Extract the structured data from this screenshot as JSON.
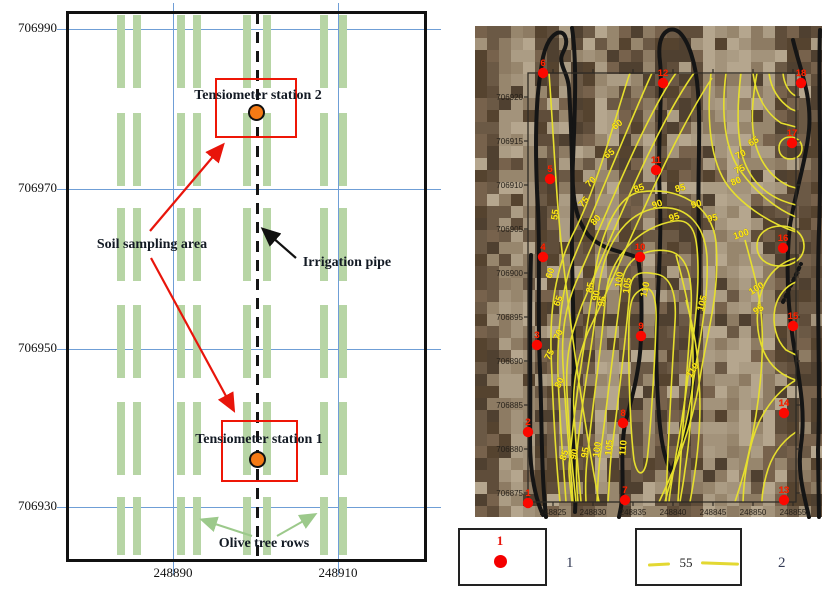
{
  "left_panel": {
    "annotations": {
      "station2": "Tensiometer station 2",
      "station1": "Tensiometer station 1",
      "soil_sampling_area": "Soil sampling area",
      "irrigation_pipe": "Irrigation pipe",
      "olive_tree_rows": "Olive tree rows"
    },
    "y_axis": [
      {
        "label": "706990",
        "y": 29
      },
      {
        "label": "706970",
        "y": 189
      },
      {
        "label": "706950",
        "y": 349
      },
      {
        "label": "706930",
        "y": 507
      }
    ],
    "x_axis": [
      {
        "label": "248890",
        "x": 173
      },
      {
        "label": "248910",
        "x": 338
      }
    ],
    "tree_grid": {
      "bar_width": 8,
      "column_bar_x": [
        [
          117,
          133
        ],
        [
          177,
          193
        ],
        [
          243,
          263
        ],
        [
          320,
          339
        ]
      ],
      "rows": [
        [
          15,
          73
        ],
        [
          113,
          73
        ],
        [
          208,
          73
        ],
        [
          305,
          73
        ],
        [
          402,
          73
        ],
        [
          497,
          58
        ]
      ]
    },
    "colors": {
      "grid_blue": "#6f9ed6",
      "tree_green": "#b7d5a5",
      "highlight_red": "#ee1607",
      "station_orange": "#f57a14"
    }
  },
  "right_panel": {
    "y_ticks": [
      {
        "label": "706920",
        "y": 97
      },
      {
        "label": "706915",
        "y": 141
      },
      {
        "label": "706910",
        "y": 185
      },
      {
        "label": "706905",
        "y": 229
      },
      {
        "label": "706900",
        "y": 273
      },
      {
        "label": "706895",
        "y": 317
      },
      {
        "label": "706890",
        "y": 361
      },
      {
        "label": "706885",
        "y": 405
      },
      {
        "label": "706880",
        "y": 449
      },
      {
        "label": "706875",
        "y": 493
      }
    ],
    "x_ticks": [
      {
        "label": "248825",
        "x": 553
      },
      {
        "label": "248830",
        "x": 593
      },
      {
        "label": "248835",
        "x": 633
      },
      {
        "label": "248840",
        "x": 673
      },
      {
        "label": "248845",
        "x": 713
      },
      {
        "label": "248850",
        "x": 753
      },
      {
        "label": "248855",
        "x": 793
      }
    ],
    "frame": {
      "x": 528,
      "y": 73,
      "w": 268,
      "h": 429
    },
    "photo": {
      "x": 475,
      "y": 26,
      "w": 347,
      "h": 491,
      "palette_light": [
        "#a3937b",
        "#ab9c84",
        "#97866d",
        "#b5a68e",
        "#8d7b63"
      ],
      "palette_dark": [
        "#6b5945",
        "#5f4d3a",
        "#77624c",
        "#4f4030",
        "#55432f"
      ],
      "dark_bands": [
        [
          488,
          26
        ],
        [
          548,
          30
        ],
        [
          580,
          22
        ],
        [
          636,
          26
        ],
        [
          678,
          46
        ],
        [
          800,
          42
        ]
      ]
    },
    "points": [
      {
        "id": "1",
        "px": 528,
        "py": 503,
        "east": 248822,
        "north": 706874
      },
      {
        "id": "2",
        "px": 528,
        "py": 432,
        "east": 248822,
        "north": 706882
      },
      {
        "id": "3",
        "px": 537,
        "py": 345,
        "east": 248823,
        "north": 706892
      },
      {
        "id": "4",
        "px": 543,
        "py": 257,
        "east": 248824,
        "north": 706902
      },
      {
        "id": "5",
        "px": 550,
        "py": 179,
        "east": 248825,
        "north": 706911
      },
      {
        "id": "6",
        "px": 543,
        "py": 73,
        "east": 248824,
        "north": 706923
      },
      {
        "id": "7",
        "px": 625,
        "py": 500,
        "east": 248834,
        "north": 706874
      },
      {
        "id": "8",
        "px": 623,
        "py": 423,
        "east": 248834,
        "north": 706883
      },
      {
        "id": "9",
        "px": 641,
        "py": 336,
        "east": 248836,
        "north": 706893
      },
      {
        "id": "10",
        "px": 640,
        "py": 257,
        "east": 248836,
        "north": 706902
      },
      {
        "id": "11",
        "px": 656,
        "py": 170,
        "east": 248838,
        "north": 706912
      },
      {
        "id": "12",
        "px": 663,
        "py": 83,
        "east": 248839,
        "north": 706922
      },
      {
        "id": "13",
        "px": 784,
        "py": 500,
        "east": 248854,
        "north": 706874
      },
      {
        "id": "14",
        "px": 784,
        "py": 413,
        "east": 248854,
        "north": 706884
      },
      {
        "id": "15",
        "px": 793,
        "py": 326,
        "east": 248855,
        "north": 706894
      },
      {
        "id": "16",
        "px": 783,
        "py": 248,
        "east": 248854,
        "north": 706903
      },
      {
        "id": "17",
        "px": 792,
        "py": 143,
        "east": 248855,
        "north": 706915
      },
      {
        "id": "18",
        "px": 801,
        "py": 83,
        "east": 248856,
        "north": 706922
      }
    ],
    "contour_labels": [
      {
        "v": "55",
        "x": 558,
        "y": 215,
        "r": -82
      },
      {
        "v": "60",
        "x": 619,
        "y": 127,
        "r": -38
      },
      {
        "v": "65",
        "x": 611,
        "y": 156,
        "r": -35
      },
      {
        "v": "70",
        "x": 593,
        "y": 184,
        "r": -45
      },
      {
        "v": "75",
        "x": 586,
        "y": 204,
        "r": -48
      },
      {
        "v": "80",
        "x": 598,
        "y": 222,
        "r": -50
      },
      {
        "v": "60",
        "x": 553,
        "y": 274,
        "r": -72
      },
      {
        "v": "65",
        "x": 561,
        "y": 302,
        "r": -68
      },
      {
        "v": "70",
        "x": 561,
        "y": 336,
        "r": -65
      },
      {
        "v": "75",
        "x": 552,
        "y": 356,
        "r": -62
      },
      {
        "v": "80",
        "x": 562,
        "y": 384,
        "r": -65
      },
      {
        "v": "85",
        "x": 640,
        "y": 191,
        "r": -20
      },
      {
        "v": "90",
        "x": 658,
        "y": 207,
        "r": -18
      },
      {
        "v": "95",
        "x": 675,
        "y": 220,
        "r": -16
      },
      {
        "v": "85",
        "x": 681,
        "y": 191,
        "r": -15
      },
      {
        "v": "90",
        "x": 697,
        "y": 207,
        "r": -14
      },
      {
        "v": "95",
        "x": 713,
        "y": 221,
        "r": -12
      },
      {
        "v": "100",
        "x": 742,
        "y": 237,
        "r": -18
      },
      {
        "v": "95",
        "x": 760,
        "y": 312,
        "r": -32
      },
      {
        "v": "100",
        "x": 758,
        "y": 291,
        "r": -32
      },
      {
        "v": "105",
        "x": 705,
        "y": 304,
        "r": -75
      },
      {
        "v": "110",
        "x": 695,
        "y": 372,
        "r": -55
      },
      {
        "v": "85",
        "x": 593,
        "y": 288,
        "r": -80
      },
      {
        "v": "90",
        "x": 599,
        "y": 296,
        "r": -80
      },
      {
        "v": "95",
        "x": 605,
        "y": 302,
        "r": -78
      },
      {
        "v": "100",
        "x": 622,
        "y": 280,
        "r": -82
      },
      {
        "v": "105",
        "x": 630,
        "y": 286,
        "r": -82
      },
      {
        "v": "110",
        "x": 648,
        "y": 290,
        "r": -78
      },
      {
        "v": "85",
        "x": 567,
        "y": 456,
        "r": -72
      },
      {
        "v": "90",
        "x": 577,
        "y": 455,
        "r": -76
      },
      {
        "v": "95",
        "x": 588,
        "y": 453,
        "r": -80
      },
      {
        "v": "100",
        "x": 600,
        "y": 450,
        "r": -82
      },
      {
        "v": "105",
        "x": 612,
        "y": 448,
        "r": -85
      },
      {
        "v": "110",
        "x": 626,
        "y": 448,
        "r": -85
      },
      {
        "v": "65",
        "x": 755,
        "y": 144,
        "r": -30
      },
      {
        "v": "70",
        "x": 742,
        "y": 157,
        "r": -28
      },
      {
        "v": "75",
        "x": 741,
        "y": 172,
        "r": -25
      },
      {
        "v": "80",
        "x": 737,
        "y": 184,
        "r": -22
      }
    ],
    "contours": [
      {
        "level": "55",
        "d": "M549,73 C554,140 556,200 563,260 C570,320 580,400 599,502"
      },
      {
        "level": "60",
        "d": "M630,73 C620,100 600,180 575,230 C558,262 550,300 551,350 C553,410 556,460 560,502"
      },
      {
        "level": "65",
        "d": "M652,73 C635,110 596,205 572,262 C562,290 557,330 558,375 C560,430 564,470 566,502"
      },
      {
        "level": "70",
        "d": "M676,73 C644,118 602,225 576,282 C566,306 561,330 563,365 C566,420 571,470 573,502"
      },
      {
        "level": "75",
        "d": "M694,73 C655,128 612,235 582,305 C572,332 565,352 567,392 C569,442 574,482 576,502"
      },
      {
        "level": "80",
        "d": "M712,78 C665,150 622,262 588,332 C578,357 572,382 574,412 C576,452 580,487 581,502"
      },
      {
        "level": "85",
        "d": "M572,502 C569,478 568,468 570,457 C575,400 585,340 593,288 C598,240 615,196 640,192 C678,186 712,205 716,242 C720,292 708,330 701,372 C692,432 673,472 659,502"
      },
      {
        "level": "90",
        "d": "M578,502 C576,482 576,466 577,452 C582,398 592,348 598,296 C602,248 624,212 658,208 C688,205 705,226 707,257 C709,300 699,342 693,384 C685,440 671,477 665,502"
      },
      {
        "level": "95",
        "d": "M586,502 C585,482 586,466 588,452 C593,400 601,352 605,302 C608,256 640,226 675,221 C696,218 698,242 698,272 C698,312 691,352 686,392 C679,442 671,480 669,502"
      },
      {
        "level": "100",
        "d": "M597,502 C598,478 599,462 601,450 C607,400 615,340 622,282 C626,256 648,248 668,251 C687,254 693,276 691,312 C688,362 682,432 678,502"
      },
      {
        "level": "105",
        "d": "M608,502 C610,474 610,460 612,449 C618,400 626,340 630,288 C632,270 644,272 656,274 C670,276 677,292 675,322 C672,372 668,442 666,502"
      },
      {
        "level": "110",
        "d": "M639,291 C650,283 657,292 656,322 C655,362 651,422 648,452 C646,476 638,480 634,460 C630,428 628,362 629,322 C630,300 633,295 639,291 Z"
      },
      {
        "level": "110",
        "d": "M686,300 C694,330 698,352 699,380 C702,420 697,465 690,502"
      },
      {
        "level": "105",
        "d": "M676,255 C684,285 690,310 692,332 C695,372 691,432 685,470 C683,486 681,495 680,502"
      },
      {
        "level": "100",
        "d": "M745,240 C753,270 759,290 761,312 C765,352 760,402 749,452 C744,476 738,492 735,502"
      },
      {
        "level": "95",
        "d": "M796,258 C780,262 768,274 762,290 C755,310 756,334 764,352 C770,366 782,376 796,380"
      },
      {
        "level": "95",
        "d": "M796,282 C786,286 778,295 775,308 C772,324 776,340 786,350 L796,355"
      },
      {
        "level": "65",
        "d": "M757,73 C752,100 750,126 756,146 C762,166 774,179 789,186 L796,188"
      },
      {
        "level": "70",
        "d": "M741,73 C737,105 737,136 743,158 C751,183 769,197 789,203 L796,205"
      },
      {
        "level": "75",
        "d": "M726,73 C721,112 724,150 742,173 C756,192 776,209 796,217"
      },
      {
        "level": "80",
        "d": "M711,73 C706,122 711,163 728,186 C744,207 772,224 796,232"
      },
      {
        "level": "",
        "d": "M783,73 C784,84 789,93 796,96"
      },
      {
        "level": "",
        "d": "M769,73 C771,89 779,101 791,109 L796,111"
      },
      {
        "level": "",
        "d": "M753,73 C756,96 766,113 781,123 L796,127"
      },
      {
        "level": "",
        "d": "M779,148 C779,141 784,137 790,137 C797,137 802,142 802,148 C802,155 797,159 790,159 C784,159 779,155 779,148 Z"
      },
      {
        "level": "",
        "d": "M757,246 C757,234 767,226 781,226 C795,226 804,235 804,246 C804,258 794,266 780,266 C766,266 757,258 757,246 Z"
      },
      {
        "level": "",
        "d": "M796,380 C779,390 767,406 759,422 C750,442 744,472 743,502"
      },
      {
        "level": "",
        "d": "M796,432 C781,442 771,456 766,476 C763,488 762,495 762,502"
      }
    ],
    "tree_outlines": [
      {
        "d": "M546,517 C541,470 542,420 540,370 C537,310 541,250 537,190 C535,140 536,98 541,70 C543,50 549,37 557,33 C565,30 568,40 565,48 C562,55 560,57 562,64 C564,72 568,76 569,88 C571,122 573,172 572,222 C571,282 576,342 573,402 C571,452 577,482 575,512"
      },
      {
        "d": "M531,255 C529,320 531,390 530,440 C530,475 536,500 543,515"
      },
      {
        "d": "M572,28 C577,60 575,110 573,160 C571,200 577,222 589,236 C605,252 628,252 638,258 C642,282 642,310 641,338 C640,370 632,398 625,424 C620,452 624,478 622,502 L619,517"
      },
      {
        "d": "M669,30 C660,34 658,46 660,62 C663,92 657,142 660,202 C662,262 654,322 657,382 C659,432 663,457 671,471 C679,457 690,422 693,382 C697,332 701,282 699,232 C697,182 701,132 698,92 C696,62 688,40 679,32 C675,29 672,29 669,30 Z"
      },
      {
        "d": "M793,40 C800,70 812,95 809,130 C806,160 796,190 790,225 C786,262 787,300 793,340 C799,380 806,410 801,445 C797,472 804,495 809,517"
      },
      {
        "d": "M820,30 C818,90 822,160 819,230 C816,300 821,380 818,450 L819,517"
      },
      {
        "d": "M783,302 L801,264",
        "dash": "2,4"
      }
    ],
    "colors": {
      "contour_yellow": "#e6df2e",
      "label_yellow": "#ffe81a",
      "point_red": "#fb0800",
      "outline_black": "#151515"
    }
  },
  "legend": {
    "item1": {
      "symbol_label": "1",
      "caption": "1"
    },
    "item2": {
      "symbol_label": "55",
      "caption": "2"
    }
  },
  "chart_data": {
    "type": "contour_map_figure",
    "panels": [
      {
        "name": "site_sketch",
        "x_ticks": [
          248890,
          248910
        ],
        "y_ticks": [
          706990,
          706970,
          706950,
          706930
        ],
        "features": [
          "olive tree rows (4 double-row columns x 6 blocks)",
          "irrigation pipe (dashed center line)",
          "Tensiometer station 2 at approx (248900, 706980)",
          "Tensiometer station 1 at approx (248900, 706936)",
          "soil sampling areas (red boxes)"
        ]
      },
      {
        "name": "soil_contour_map",
        "x_range": [
          248822,
          248856
        ],
        "y_range": [
          706874,
          706923
        ],
        "x_ticks": [
          248825,
          248830,
          248835,
          248840,
          248845,
          248850,
          248855
        ],
        "y_ticks": [
          706875,
          706880,
          706885,
          706890,
          706895,
          706900,
          706905,
          706910,
          706915,
          706920
        ],
        "contour_levels": [
          55,
          60,
          65,
          70,
          75,
          80,
          85,
          90,
          95,
          100,
          105,
          110
        ],
        "sampling_points": [
          {
            "id": 1,
            "east": 248822,
            "north": 706874
          },
          {
            "id": 2,
            "east": 248822,
            "north": 706882
          },
          {
            "id": 3,
            "east": 248823,
            "north": 706892
          },
          {
            "id": 4,
            "east": 248824,
            "north": 706902
          },
          {
            "id": 5,
            "east": 248825,
            "north": 706911
          },
          {
            "id": 6,
            "east": 248824,
            "north": 706923
          },
          {
            "id": 7,
            "east": 248834,
            "north": 706874
          },
          {
            "id": 8,
            "east": 248834,
            "north": 706883
          },
          {
            "id": 9,
            "east": 248836,
            "north": 706893
          },
          {
            "id": 10,
            "east": 248836,
            "north": 706902
          },
          {
            "id": 11,
            "east": 248838,
            "north": 706912
          },
          {
            "id": 12,
            "east": 248839,
            "north": 706922
          },
          {
            "id": 13,
            "east": 248854,
            "north": 706874
          },
          {
            "id": 14,
            "east": 248854,
            "north": 706884
          },
          {
            "id": 15,
            "east": 248855,
            "north": 706894
          },
          {
            "id": 16,
            "east": 248854,
            "north": 706903
          },
          {
            "id": 17,
            "east": 248855,
            "north": 706915
          },
          {
            "id": 18,
            "east": 248856,
            "north": 706922
          }
        ],
        "legend": [
          {
            "symbol": "red dot",
            "meaning_label": "1"
          },
          {
            "symbol": "yellow contour 55",
            "meaning_label": "2"
          }
        ]
      }
    ]
  }
}
